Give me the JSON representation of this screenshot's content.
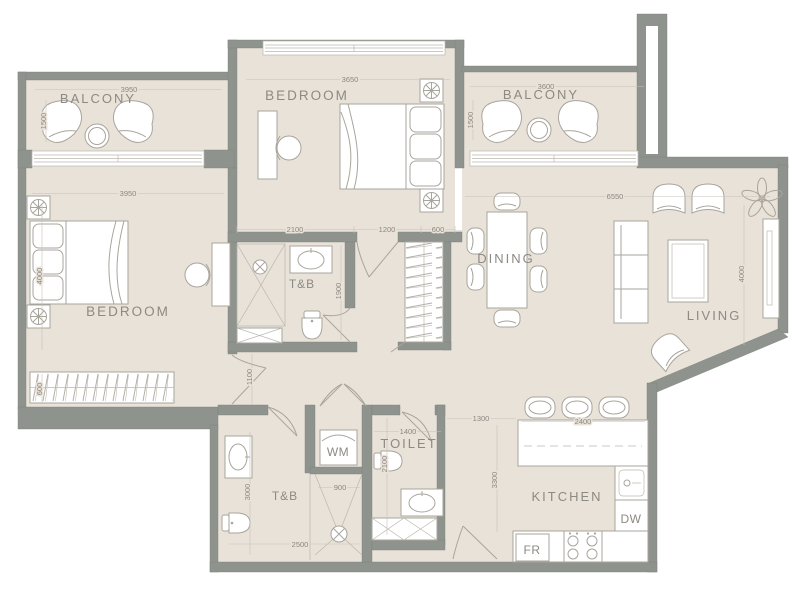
{
  "plan": {
    "rooms": {
      "balcony_left": "BALCONY",
      "bedroom_top": "BEDROOM",
      "balcony_right": "BALCONY",
      "bedroom_left": "BEDROOM",
      "tb_upper": "T&B",
      "dining": "DINING",
      "living": "LIVING",
      "toilet": "TOILET",
      "tb_lower": "T&B",
      "kitchen": "KITCHEN"
    },
    "appliances": {
      "washing_machine": "WM",
      "dishwasher": "DW",
      "fridge": "FR"
    },
    "dimensions_mm": {
      "balcony_left_width": "3950",
      "balcony_left_depth": "1500",
      "bedroom_top_width": "3650",
      "bedroom_top_seg1": "2100",
      "bedroom_top_seg2": "1200",
      "closet_width": "600",
      "balcony_right_width": "3600",
      "balcony_right_depth": "1500",
      "bedroom_left_width": "3950",
      "bedroom_left_depth": "4000",
      "wardrobe_depth": "600",
      "living_width": "6550",
      "living_depth": "4000",
      "tb_upper_depth": "1900",
      "hall_width": "1100",
      "tb_lower_depth": "3000",
      "tb_lower_width": "2500",
      "shower_width": "900",
      "toilet_width": "1400",
      "toilet_depth": "2100",
      "passage_width": "1300",
      "kitchen_depth": "3300",
      "island_width": "2400"
    },
    "colors": {
      "wall": "#8e948d",
      "floor": "#e8e2d9",
      "furniture_line": "#a9a59c",
      "label_text": "#8d8983",
      "background": "#ffffff"
    }
  }
}
